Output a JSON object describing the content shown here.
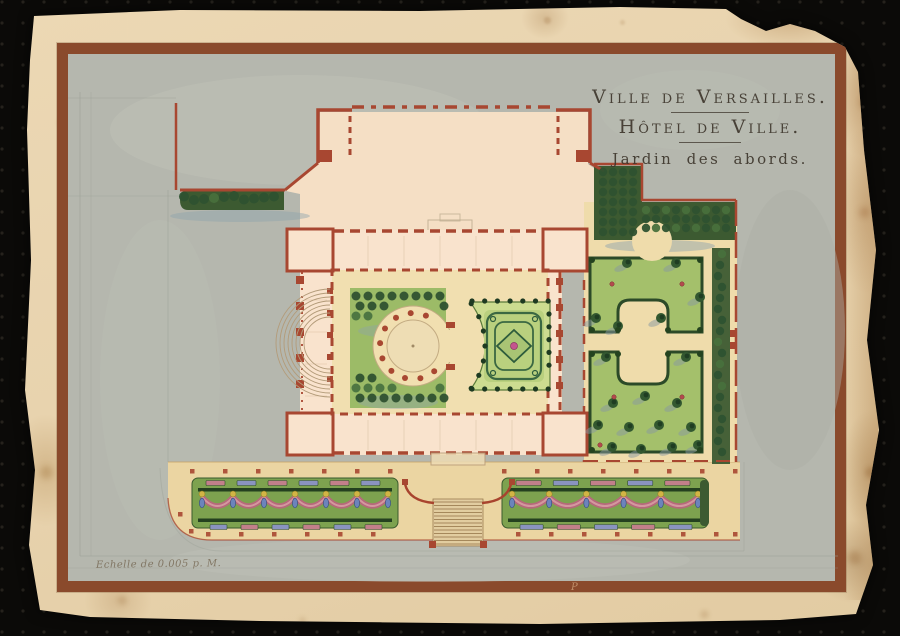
{
  "artwork": {
    "title_line1": "Ville de Versailles.",
    "title_line2": "Hôtel de Ville.",
    "title_line3": "Jardin des abords.",
    "scale_note": "Echelle de 0.005 p. M.",
    "border_mark": "P"
  },
  "colors": {
    "frame_brown": "#8a4a2c",
    "wall_red": "#a84731",
    "lawn_green": "#a4c06b",
    "hedge_green": "#3c5a31",
    "paper_cream": "#e8d3ae",
    "street_gray": "#b5b7ae",
    "sand": "#efdcab",
    "terrace_sand": "#ebd5a2",
    "court_sand": "#f1dfb0",
    "building_pink": "#f9e3cd",
    "forecourt_pink": "#f5dfc5",
    "parterre_green": "#ccdc90",
    "garland_pink": "#b5697a",
    "vase_blue": "#6c84bb"
  }
}
